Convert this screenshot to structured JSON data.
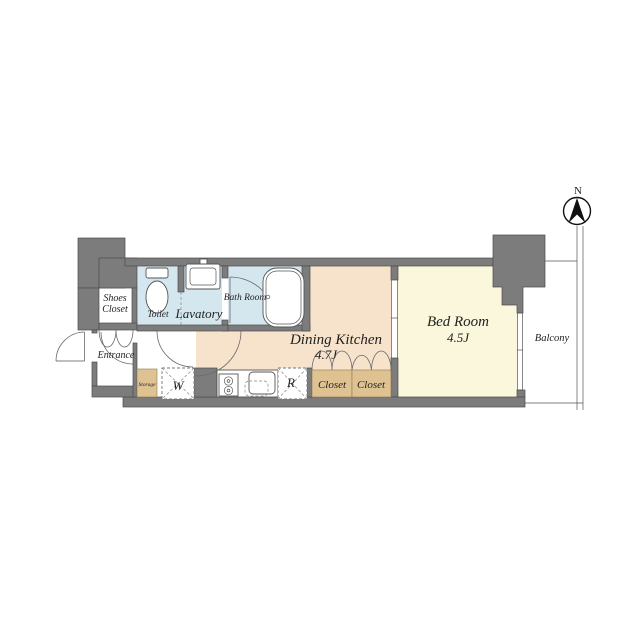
{
  "compass": {
    "label": "N"
  },
  "rooms": {
    "shoes_closet": {
      "line1": "Shoes",
      "line2": "Closet"
    },
    "entrance": {
      "label": "Entrance"
    },
    "toilet": {
      "label": "Toilet"
    },
    "lavatory": {
      "label": "Lavatory"
    },
    "bath_room": {
      "label": "Bath Room"
    },
    "dining_kitchen": {
      "label": "Dining Kitchen",
      "size": "4.7J"
    },
    "bed_room": {
      "label": "Bed Room",
      "size": "4.5J"
    },
    "closet_left": {
      "label": "Closet"
    },
    "closet_right": {
      "label": "Closet"
    },
    "storage": {
      "label": "Storage"
    },
    "balcony": {
      "label": "Balcony"
    },
    "washer_space": {
      "label": "W"
    },
    "refrigerator_space": {
      "label": "R"
    }
  },
  "colors": {
    "background": "#ffffff",
    "wall": "#7c7c7c",
    "wall_edge": "#4c4c4c",
    "wet_room": "#d4e6ee",
    "dining": "#f7e3cb",
    "bedroom": "#fbf7dc",
    "closet": "#dfc291",
    "line": "#555555",
    "text": "#222222"
  }
}
